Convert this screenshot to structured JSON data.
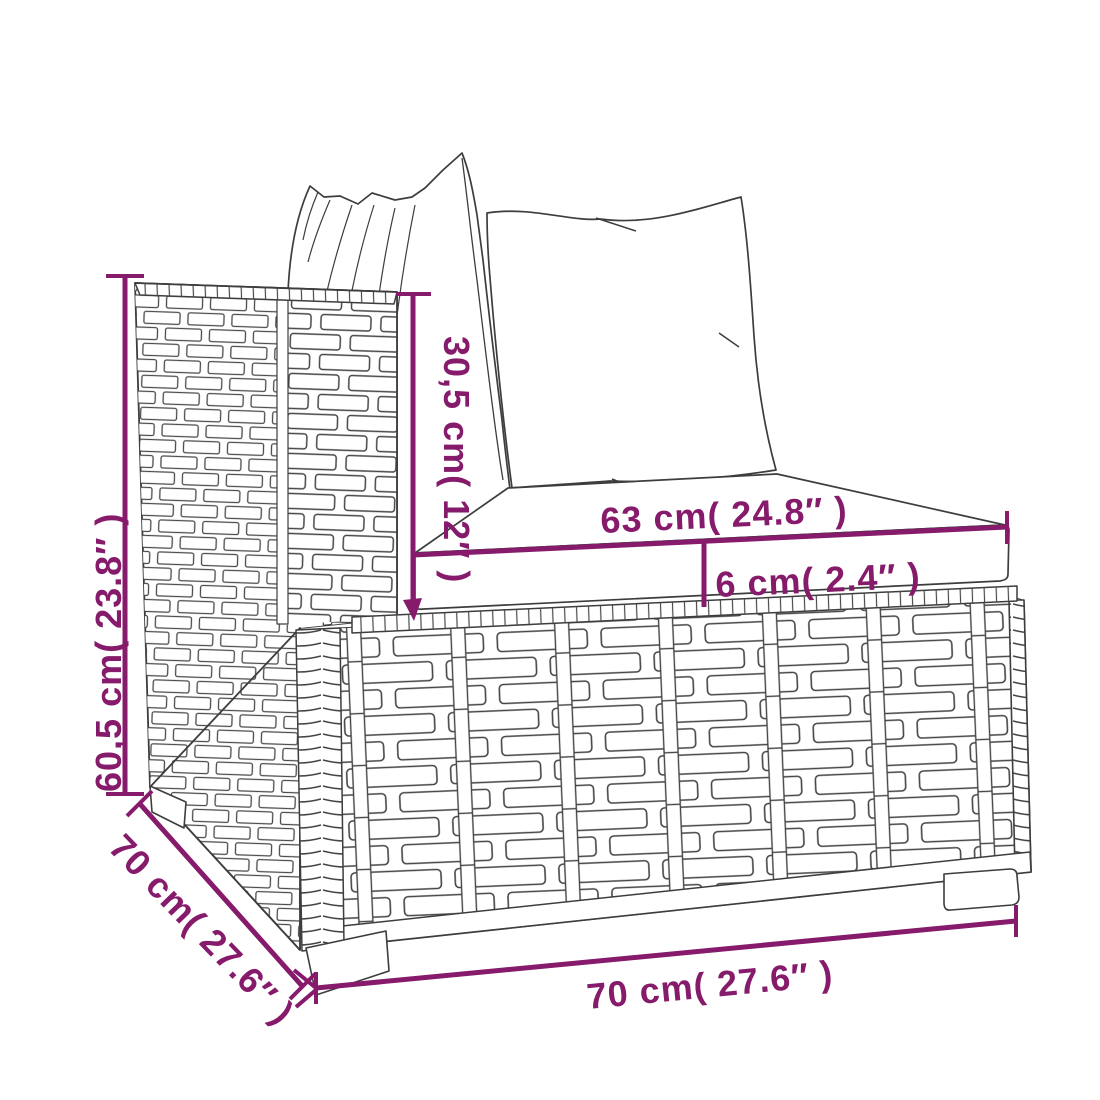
{
  "figure": {
    "type": "product-dimension-diagram",
    "product": "rattan corner sofa section with cushions (line art)",
    "dimensions": {
      "total_height": "60,5 cm( 23.8″ )",
      "armrest_above_seat": "30,5 cm( 12″ )",
      "cushion_width": "63 cm( 24.8″ )",
      "cushion_thickness": "6 cm( 2.4″ )",
      "front_width": "70 cm( 27.6″ )",
      "side_depth": "70 cm( 27.6″ )"
    },
    "colors": {
      "dimension_accent": "#861a6b",
      "line_art": "#3d3d3d",
      "background": "#ffffff"
    }
  }
}
